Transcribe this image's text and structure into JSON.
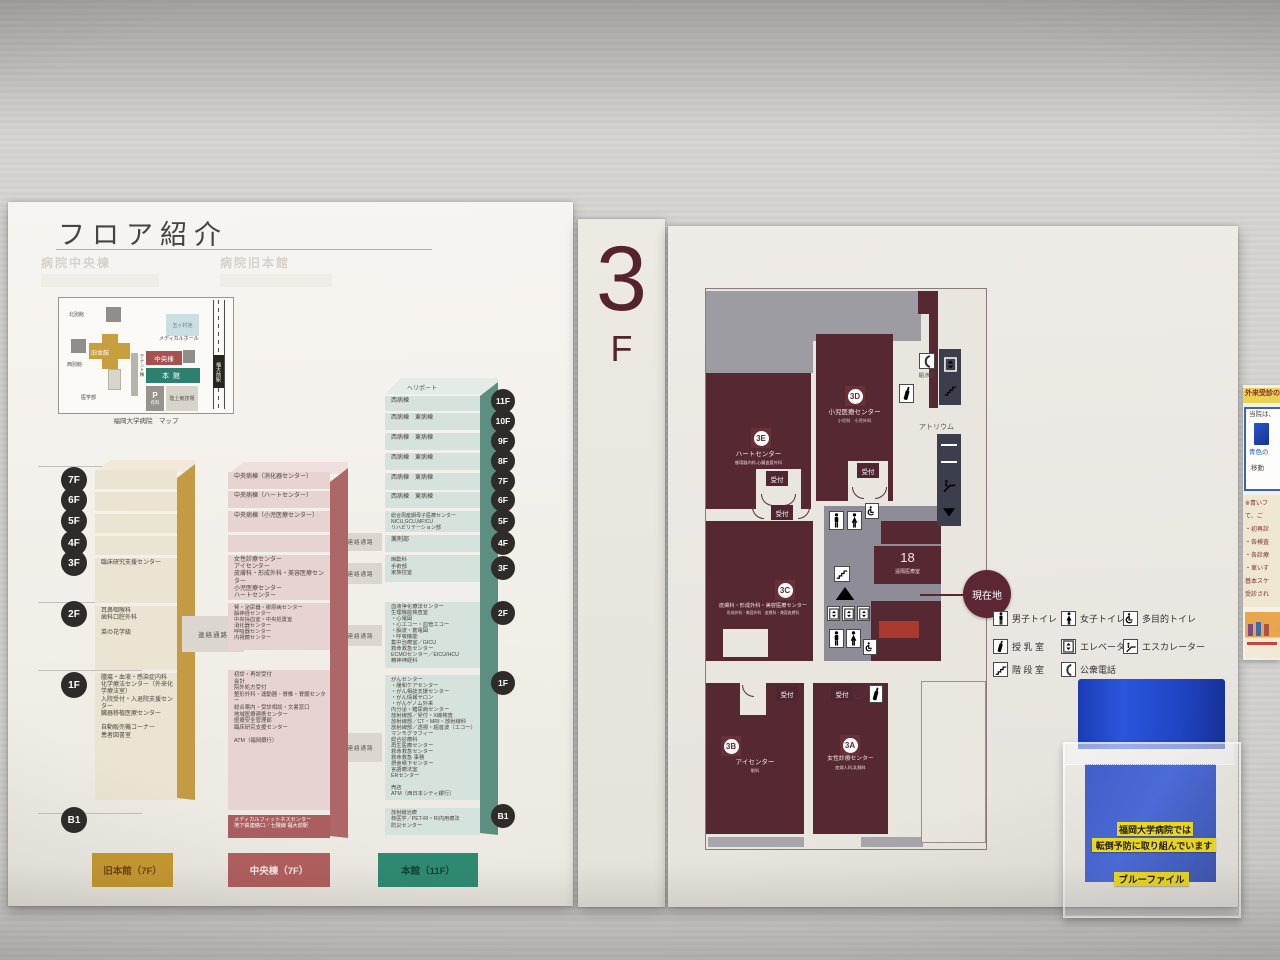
{
  "left_panel": {
    "title": "フロア紹介",
    "ghost_left": "病院中央棟",
    "ghost_right": "病院旧本館",
    "campus_map": {
      "caption": "福岡大学病院　マップ",
      "north_annex": "北別館",
      "old_main": "旧本館",
      "west_annex": "西別館",
      "medical_school": "医学部",
      "tenant": "テナント棟",
      "pond": "五ヶ村池",
      "medical_hall": "メディカルホール",
      "central_bldg": "中央棟",
      "main_bldg": "本館",
      "parking": "P",
      "parking_sub": "有料",
      "athletics": "陸上競技場",
      "station": "福大前駅"
    },
    "corridor": "連絡通路",
    "heliport": "ヘリポート",
    "badges_left": [
      "7F",
      "6F",
      "5F",
      "4F",
      "3F",
      "2F",
      "1F",
      "B1"
    ],
    "badges_right": [
      "11F",
      "10F",
      "9F",
      "8F",
      "7F",
      "6F",
      "5F",
      "4F",
      "3F",
      "2F",
      "1F",
      "B1"
    ],
    "old_tower": {
      "label": "旧本館（7F）",
      "f3": "臨床研究支援センター",
      "f2": "耳鼻咽喉科\n歯科口腔外科\n\n菜の花学級",
      "f1": "腫瘍・血液・感染症内科\n化学療法センター（外来化学療法室）\n入院受付・入退院支援センター\n臓器移植医療センター\n\n自動販売機コーナー\n患者図書室"
    },
    "central_tower": {
      "label": "中央棟（7F）",
      "f7": "中央病棟（消化器センター）",
      "f6": "中央病棟（ハートセンター）",
      "f5": "中央病棟（小児医療センター）",
      "f3": "女性診療センター\nアイセンター\n皮膚科・形成外科・美容医療センター\n小児医療センター\nハートセンター",
      "f2": "腎・泌尿器・膠原病センター\n脳神経センター\n中央採血室・中央処置室\n消化器センター\n呼吸器センター\n内視鏡センター",
      "f1": "初診・再診受付\n会計\n院外処方受付\n整形外科・運動器・脊椎・脊髄センター\n総合案内・受診相談・文書窓口\n地域医療連携センター\n医療安全管理部\n臨床研究支援センター\n\nATM（福岡銀行）",
      "b1": "メディカルフィットネスセンター\n地下鉄連絡口／七隈線 福大前駅"
    },
    "main_tower": {
      "label": "本館（11F）",
      "f11": "西病棟",
      "f10": "西病棟　東病棟",
      "f9": "西病棟　東病棟",
      "f8": "西病棟　東病棟",
      "f7": "西病棟　東病棟",
      "f6": "西病棟　東病棟",
      "f5": "総合周産期母子医療センター\nNICU,GCU,MFICU\nリハビリテーション部",
      "f4": "薬剤部",
      "f3": "麻酔科\n手術部\n家族控室",
      "f2": "血液浄化療法センター\n生理機能検査室\n・心電図\n・心エコー・血管エコー\n・脳波・筋電図\n・呼吸機能\n集中治療室／GICU\n救命救急センター\nECMOセンター／EICU/HCU\n精神神経科",
      "f1": "がんセンター\n・緩和ケアセンター\n・がん相談支援センター\n・がん情報サロン\n・がんゲノム外来\n内分泌・糖尿病センター\n放射線部／受付・X線検査\n放射線部／CT・MRI・放射線科\n放射線部／透視・超音波（エコー）\nマンモグラフィー\n総合診療科\n再生医療センター\n救命救急センター\n救命救急 事務\n摂食嚥下センター\n言語療法室\nERセンター\n\n売店\nATM（西日本シティ銀行）",
      "b1": "放射線治療\n核医学／PET-RI・RI内用療法\n防災センター"
    }
  },
  "floor_sign": {
    "number": "3",
    "letter": "F"
  },
  "map_panel": {
    "reception": "受付",
    "rooms": {
      "e3": {
        "badge": "3E",
        "name": "ハートセンター",
        "sub": "循環器内科,心臓血管外科"
      },
      "d3": {
        "badge": "3D",
        "name": "小児医療センター",
        "sub": "小児科　小児外科"
      },
      "c3": {
        "badge": "3C",
        "name": "皮膚科・形成外科・美容医療センター",
        "sub": "形成外科・美容外科　皮膚科・美容皮膚科"
      },
      "b3": {
        "badge": "3B",
        "name": "アイセンター",
        "sub": "眼科"
      },
      "a3": {
        "badge": "3A",
        "name": "女性診療センター",
        "sub": "産婦人科,乳腺科"
      }
    },
    "room18_number": "18",
    "room18_name": "遠隔医療室",
    "atrium": "アトリウム",
    "water": "給水器",
    "here": "現在地",
    "legend": [
      {
        "icon": "mens-toilet-icon",
        "label": "男子トイレ"
      },
      {
        "icon": "womens-toilet-icon",
        "label": "女子トイレ"
      },
      {
        "icon": "accessible-toilet-icon",
        "label": "多目的トイレ"
      },
      {
        "icon": "nursing-room-icon",
        "label": "授 乳 室"
      },
      {
        "icon": "elevator-icon",
        "label": "エレベーター"
      },
      {
        "icon": "escalator-icon",
        "label": "エスカレーター"
      },
      {
        "icon": "stairs-icon",
        "label": "階 段 室"
      },
      {
        "icon": "public-phone-icon",
        "label": "公衆電話"
      }
    ]
  },
  "notice": {
    "header": "外来受診の",
    "line1": "当院は、",
    "line2": "青色の",
    "line3": "移動",
    "body": "※青いフ\nて、ご\n・初再診\n・各検査\n・各診療\n・車いす\n基本スケ\n受診され"
  },
  "file_holder": {
    "line1": "福岡大学病院では",
    "line2": "転倒予防に取り組んでいます",
    "label": "ブルーファイル"
  },
  "colors": {
    "map_room": "#552832",
    "current_location": "#5c2733",
    "highlight_red": "#a93a30",
    "old_tower_gold": "#c79f3e",
    "central_tower_red": "#b15f5e",
    "main_tower_teal": "#2f8a72",
    "file_blue": "#2148c9",
    "label_yellow": "#f2de20"
  }
}
